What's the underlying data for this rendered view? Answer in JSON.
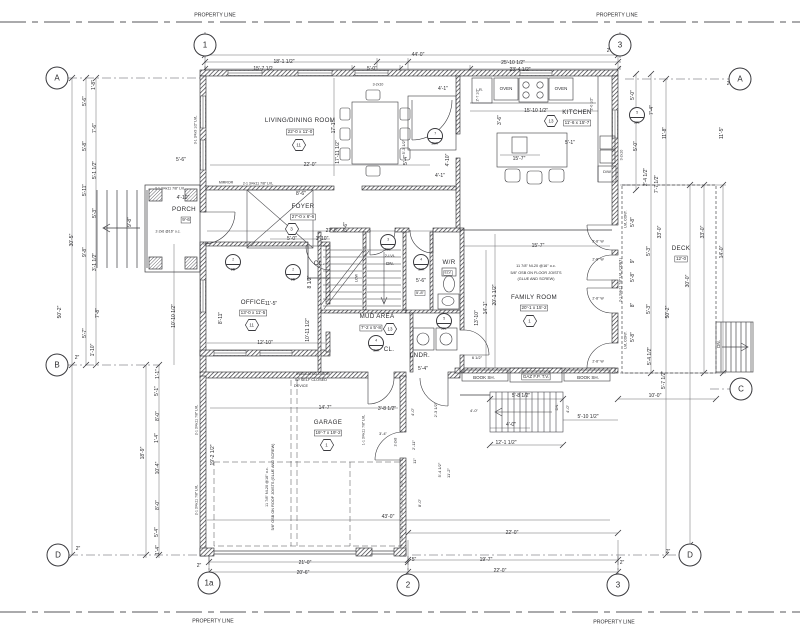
{
  "colors": {
    "background": "#ffffff",
    "line": "#5a5a5e",
    "wall": "#26262a",
    "text": "#2b2b2e"
  },
  "property_labels": [
    {
      "t": "PROPERTY LINE"
    },
    {
      "t": "PROPERTY LINE"
    },
    {
      "t": "PROPERTY LINE"
    },
    {
      "t": "PROPERTY LINE"
    }
  ],
  "grid_bubbles": [
    {
      "l": "1",
      "x": 205,
      "y": 45
    },
    {
      "l": "3",
      "x": 620,
      "y": 45
    },
    {
      "l": "A",
      "x": 57,
      "y": 78
    },
    {
      "l": "B",
      "x": 57,
      "y": 365
    },
    {
      "l": "D",
      "x": 58,
      "y": 555
    },
    {
      "l": "A",
      "x": 740,
      "y": 79
    },
    {
      "l": "C",
      "x": 741,
      "y": 389
    },
    {
      "l": "D",
      "x": 690,
      "y": 555
    },
    {
      "l": "1a",
      "x": 209,
      "y": 583
    },
    {
      "l": "2",
      "x": 408,
      "y": 585
    },
    {
      "l": "3",
      "x": 618,
      "y": 585
    }
  ],
  "rooms": [
    {
      "name": {
        "t": "LIVING/DINING ROOM",
        "x": 300,
        "y": 121
      },
      "size": {
        "t": "22'-0 x 11'-0",
        "x": 300,
        "y": 132
      },
      "tag": {
        "t": "11",
        "x": 299,
        "y": 145
      }
    },
    {
      "name": {
        "t": "KITCHEN",
        "x": 577,
        "y": 113
      },
      "size": {
        "t": "11'-6 x 15'-7",
        "x": 577,
        "y": 123
      },
      "tag": {
        "t": "13",
        "x": 551,
        "y": 121
      }
    },
    {
      "name": {
        "t": "FOYER",
        "x": 303,
        "y": 207
      },
      "size": {
        "t": "27'-0 x 6'-6",
        "x": 303,
        "y": 217
      },
      "tag": {
        "t": "3",
        "x": 292,
        "y": 229
      }
    },
    {
      "name": {
        "t": "PORCH",
        "x": 184,
        "y": 210
      },
      "size": {
        "t": "9'-6",
        "x": 186,
        "y": 220
      }
    },
    {
      "name": {
        "t": "OFFICE",
        "x": 253,
        "y": 303
      },
      "size": {
        "t": "13'-0 x 11'-5",
        "x": 253,
        "y": 313
      },
      "tag": {
        "t": "11",
        "x": 252,
        "y": 325
      }
    },
    {
      "name": {
        "t": "MUD AREA",
        "x": 377,
        "y": 317
      },
      "size": {
        "t": "7'-2 x 5'-8",
        "x": 371,
        "y": 328
      },
      "tag": {
        "t": "13",
        "x": 390,
        "y": 329
      }
    },
    {
      "name": {
        "t": "FAMILY ROOM",
        "x": 534,
        "y": 298
      },
      "size": {
        "t": "20'-1 x 15'-2",
        "x": 534,
        "y": 308
      },
      "tag": {
        "t": "1",
        "x": 530,
        "y": 321
      }
    },
    {
      "name": {
        "t": "GARAGE",
        "x": 328,
        "y": 423
      },
      "size": {
        "t": "19'-7 x 19'-2",
        "x": 328,
        "y": 433
      },
      "tag": {
        "t": "1",
        "x": 327,
        "y": 445
      }
    },
    {
      "name": {
        "t": "DECK",
        "x": 681,
        "y": 249
      },
      "size": {
        "t": "12'-0",
        "x": 681,
        "y": 259
      }
    },
    {
      "name": {
        "t": "W/R",
        "x": 449,
        "y": 263
      }
    },
    {
      "name": {
        "t": "LNDR.",
        "x": 420,
        "y": 356
      }
    },
    {
      "name": {
        "t": "CL.",
        "x": 319,
        "y": 264
      }
    },
    {
      "name": {
        "t": "CL.",
        "x": 389,
        "y": 350
      }
    }
  ],
  "door_tags": [
    {
      "top": "2",
      "bottom": "2B",
      "x": 233,
      "y": 262
    },
    {
      "top": "2",
      "bottom": "2B",
      "x": 293,
      "y": 272
    },
    {
      "top": "7",
      "bottom": "2BR",
      "x": 435,
      "y": 136
    },
    {
      "top": "3",
      "bottom": "30L",
      "x": 388,
      "y": 242
    },
    {
      "top": "4",
      "bottom": "30R",
      "x": 421,
      "y": 262
    },
    {
      "top": "4",
      "bottom": "30R",
      "x": 376,
      "y": 343
    },
    {
      "top": "5",
      "bottom": "30L",
      "x": 444,
      "y": 321
    },
    {
      "top": "5",
      "bottom": "30L",
      "x": 637,
      "y": 115
    }
  ],
  "labels": [
    {
      "t": "44'-0\"",
      "x": 418,
      "y": 55
    },
    {
      "t": "18'-1 1/2\"",
      "x": 284,
      "y": 62
    },
    {
      "t": "15'-7 1/2",
      "x": 263,
      "y": 69
    },
    {
      "t": "5'-0\"",
      "x": 372,
      "y": 69
    },
    {
      "t": "25'-10 1/2\"",
      "x": 513,
      "y": 63
    },
    {
      "t": "23'-4 1/2\"",
      "x": 520,
      "y": 70
    },
    {
      "t": "2\"",
      "x": 213,
      "y": 49
    },
    {
      "t": "2\"",
      "x": 609,
      "y": 51
    },
    {
      "t": "21'-0\"",
      "x": 305,
      "y": 563
    },
    {
      "t": "20'-6\"",
      "x": 303,
      "y": 573
    },
    {
      "t": "2\"",
      "x": 199,
      "y": 566
    },
    {
      "t": "5\"",
      "x": 414,
      "y": 560
    },
    {
      "t": "22'-0\"",
      "x": 512,
      "y": 533
    },
    {
      "t": "19'-7\"",
      "x": 486,
      "y": 560
    },
    {
      "t": "22'-0\"",
      "x": 500,
      "y": 571
    },
    {
      "t": "2\"",
      "x": 622,
      "y": 563
    },
    {
      "t": "2\"",
      "x": 668,
      "y": 552
    },
    {
      "t": "1'-8\"",
      "x": 94,
      "y": 85,
      "r": -90
    },
    {
      "t": "5'-6\"",
      "x": 85,
      "y": 101,
      "r": -90
    },
    {
      "t": "7'-6\"",
      "x": 95,
      "y": 128,
      "r": -90
    },
    {
      "t": "5'-8\"",
      "x": 85,
      "y": 146,
      "r": -90
    },
    {
      "t": "5'-1 1/2\"",
      "x": 95,
      "y": 170,
      "r": -90
    },
    {
      "t": "5'-11\"",
      "x": 85,
      "y": 190,
      "r": -90
    },
    {
      "t": "5'-3\"",
      "x": 95,
      "y": 213,
      "r": -90
    },
    {
      "t": "9'-8\"",
      "x": 85,
      "y": 252,
      "r": -90
    },
    {
      "t": "3'-1 1/2\"",
      "x": 95,
      "y": 262,
      "r": -90
    },
    {
      "t": "30'-5\"",
      "x": 72,
      "y": 240,
      "r": -90
    },
    {
      "t": "50'-2\"",
      "x": 60,
      "y": 312,
      "r": -90
    },
    {
      "t": "7'-8\"",
      "x": 98,
      "y": 313,
      "r": -90
    },
    {
      "t": "5'-7\"",
      "x": 85,
      "y": 333,
      "r": -90
    },
    {
      "t": "1'-10\"",
      "x": 93,
      "y": 350,
      "r": -90
    },
    {
      "t": "2\"",
      "x": 77,
      "y": 358
    },
    {
      "t": "2\"",
      "x": 78,
      "y": 549
    },
    {
      "t": "10'-10 1/2\"",
      "x": 174,
      "y": 316,
      "r": -90
    },
    {
      "t": "1'-1\"",
      "x": 158,
      "y": 374,
      "r": -90
    },
    {
      "t": "5'-1\"",
      "x": 157,
      "y": 391,
      "r": -90
    },
    {
      "t": "8'-0\"",
      "x": 158,
      "y": 416,
      "r": -90
    },
    {
      "t": "1'-4\"",
      "x": 157,
      "y": 438,
      "r": -90
    },
    {
      "t": "18'-9\"",
      "x": 143,
      "y": 453,
      "r": -90
    },
    {
      "t": "10'-4\"",
      "x": 158,
      "y": 468,
      "r": -90
    },
    {
      "t": "8'-0\"",
      "x": 158,
      "y": 505,
      "r": -90
    },
    {
      "t": "5'-4\"",
      "x": 157,
      "y": 532,
      "r": -90
    },
    {
      "t": "1'-4\"",
      "x": 158,
      "y": 550,
      "r": -90
    },
    {
      "t": "7'-4\"",
      "x": 652,
      "y": 110,
      "r": -90
    },
    {
      "t": "11'-8\"",
      "x": 665,
      "y": 133,
      "r": -90
    },
    {
      "t": "11'-5\"",
      "x": 722,
      "y": 133,
      "r": -90
    },
    {
      "t": "5'-0\"",
      "x": 636,
      "y": 146,
      "r": -90
    },
    {
      "t": "2'-4 1/2\"",
      "x": 646,
      "y": 177,
      "r": -90
    },
    {
      "t": "7'-7 1/2\"",
      "x": 657,
      "y": 184,
      "r": -90
    },
    {
      "t": "2\"",
      "x": 729,
      "y": 84
    },
    {
      "t": "33'-0\"",
      "x": 660,
      "y": 232,
      "r": -90
    },
    {
      "t": "33'-0\"",
      "x": 703,
      "y": 232,
      "r": -90
    },
    {
      "t": "30'-0\"",
      "x": 688,
      "y": 281,
      "r": -90
    },
    {
      "t": "14'-0\"",
      "x": 722,
      "y": 252,
      "r": -90
    },
    {
      "t": "50'-2\"",
      "x": 668,
      "y": 312,
      "r": -90
    },
    {
      "t": "5'-8\"",
      "x": 633,
      "y": 222,
      "r": -90
    },
    {
      "t": "9\"",
      "x": 633,
      "y": 261,
      "r": -90
    },
    {
      "t": "5'-3\"",
      "x": 649,
      "y": 251,
      "r": -90
    },
    {
      "t": "5'-8\"",
      "x": 633,
      "y": 277,
      "r": -90
    },
    {
      "t": "8\"",
      "x": 633,
      "y": 305,
      "r": -90
    },
    {
      "t": "5'-3\"",
      "x": 649,
      "y": 309,
      "r": -90
    },
    {
      "t": "5'-8\"",
      "x": 633,
      "y": 337,
      "r": -90
    },
    {
      "t": "5'-4 1/2\"",
      "x": 650,
      "y": 356,
      "r": -90
    },
    {
      "t": "LVL CONT.",
      "x": 626,
      "y": 219,
      "r": -90,
      "s": 3.5
    },
    {
      "t": "LVL CONT.",
      "x": 626,
      "y": 340,
      "r": -90,
      "s": 3.5
    },
    {
      "t": "2-1 3/4x11 7/8\" LVL (CONT.)",
      "x": 621,
      "y": 280,
      "r": -90,
      "s": 3.5
    },
    {
      "t": "5'-7 1/2\"",
      "x": 664,
      "y": 380,
      "r": -90
    },
    {
      "t": "10'-0\"",
      "x": 655,
      "y": 396
    },
    {
      "t": "2'-8\" W",
      "x": 598,
      "y": 242,
      "s": 3.5
    },
    {
      "t": "2'-8\" W",
      "x": 598,
      "y": 260,
      "s": 3.5
    },
    {
      "t": "2'-8\" W",
      "x": 598,
      "y": 299,
      "s": 3.5
    },
    {
      "t": "2'-8\" W",
      "x": 598,
      "y": 362,
      "s": 3.5
    },
    {
      "t": "OVEN",
      "x": 506,
      "y": 89,
      "s": 4.5
    },
    {
      "t": "OVEN",
      "x": 561,
      "y": 89,
      "s": 4.5
    },
    {
      "t": "R.",
      "x": 481,
      "y": 90,
      "s": 4
    },
    {
      "t": "15'-10 1/2\"",
      "x": 536,
      "y": 111
    },
    {
      "t": "3'-6\"",
      "x": 500,
      "y": 120,
      "r": -90
    },
    {
      "t": "5'-1\"",
      "x": 570,
      "y": 143
    },
    {
      "t": "15'-7\"",
      "x": 519,
      "y": 159
    },
    {
      "t": "D/W",
      "x": 607,
      "y": 172,
      "s": 4
    },
    {
      "t": "2'-0 1/2\"",
      "x": 592,
      "y": 104,
      "r": -90,
      "s": 3.5
    },
    {
      "t": "5'-0\"",
      "x": 633,
      "y": 95,
      "r": -90
    },
    {
      "t": "3-2x10",
      "x": 622,
      "y": 155,
      "r": -90,
      "s": 3.5
    },
    {
      "t": "4'-1\"",
      "x": 443,
      "y": 89
    },
    {
      "t": "2'-7 1/2\"",
      "x": 478,
      "y": 95,
      "r": -90,
      "s": 3.5
    },
    {
      "t": "4'-10\"",
      "x": 448,
      "y": 160,
      "r": -90
    },
    {
      "t": "4'-1\"",
      "x": 440,
      "y": 176
    },
    {
      "t": "5'-4\"",
      "x": 406,
      "y": 160,
      "r": -90
    },
    {
      "t": "5'-3 1/2\"",
      "x": 404,
      "y": 147,
      "r": -90,
      "s": 4
    },
    {
      "t": "22'-0\"",
      "x": 310,
      "y": 165
    },
    {
      "t": "17'-1\"",
      "x": 334,
      "y": 127,
      "r": -90
    },
    {
      "t": "17'-11 1/2\"",
      "x": 338,
      "y": 152,
      "r": -90
    },
    {
      "t": "3-2x10",
      "x": 378,
      "y": 85,
      "s": 3.5
    },
    {
      "t": "3-1 3/4x9 1/2\" LVL",
      "x": 196,
      "y": 130,
      "r": -90,
      "s": 3.5
    },
    {
      "t": "MIRROR",
      "x": 226,
      "y": 183,
      "s": 3.5
    },
    {
      "t": "2-1 3/4x11 7/8\" LVL",
      "x": 258,
      "y": 184,
      "s": 3.5
    },
    {
      "t": "8'-6\"",
      "x": 301,
      "y": 194
    },
    {
      "t": "27'-0\"",
      "x": 332,
      "y": 231
    },
    {
      "t": "5'-0\"",
      "x": 292,
      "y": 239
    },
    {
      "t": "1'-10\"",
      "x": 322,
      "y": 239
    },
    {
      "t": "6'-6\"",
      "x": 346,
      "y": 227,
      "r": -90
    },
    {
      "t": "8 1/2\"",
      "x": 310,
      "y": 282,
      "r": -90
    },
    {
      "t": "5'-6\"",
      "x": 181,
      "y": 160
    },
    {
      "t": "4'-10\"",
      "x": 183,
      "y": 198
    },
    {
      "t": "9'-8\"",
      "x": 130,
      "y": 222,
      "r": -90
    },
    {
      "t": "2-2x6 @16\" o.c.",
      "x": 168,
      "y": 232,
      "s": 3.5
    },
    {
      "t": "2-1 3/4x11 7/8\" LVL",
      "x": 170,
      "y": 189,
      "s": 3.5
    },
    {
      "t": "11'-5\"",
      "x": 271,
      "y": 304
    },
    {
      "t": "8'-11\"",
      "x": 221,
      "y": 318,
      "r": -90
    },
    {
      "t": "12'-10\"",
      "x": 265,
      "y": 343
    },
    {
      "t": "10'-11 1/2\"",
      "x": 308,
      "y": 330,
      "r": -90
    },
    {
      "t": "2-LVL",
      "x": 390,
      "y": 256,
      "s": 4
    },
    {
      "t": "DN.",
      "x": 390,
      "y": 264,
      "s": 4.5
    },
    {
      "t": "LOW",
      "x": 357,
      "y": 278,
      "r": -90,
      "s": 3.5
    },
    {
      "t": "5'-6\"",
      "x": 421,
      "y": 281
    },
    {
      "t": "5'-8\"",
      "x": 420,
      "y": 293,
      "b": 1,
      "s": 4
    },
    {
      "t": "ELV.",
      "x": 448,
      "y": 273,
      "b": 1,
      "s": 3.5
    },
    {
      "t": "5'-4\"",
      "x": 423,
      "y": 369
    },
    {
      "t": "6 1/2\"",
      "x": 477,
      "y": 358,
      "s": 4
    },
    {
      "t": "15'-7\"",
      "x": 538,
      "y": 246
    },
    {
      "t": "11 7/8\" NI-20 @16\" o.c.",
      "x": 536,
      "y": 266,
      "s": 3.8
    },
    {
      "t": "5/8\" OSB ON FLOOR JOISTS",
      "x": 536,
      "y": 273,
      "s": 3.8
    },
    {
      "t": "(GLUE AND SCREW)",
      "x": 536,
      "y": 279,
      "s": 3.8
    },
    {
      "t": "20'-1 1/2\"",
      "x": 495,
      "y": 295,
      "r": -90
    },
    {
      "t": "14'-1\"",
      "x": 486,
      "y": 308,
      "r": -90
    },
    {
      "t": "13'-10\"",
      "x": 477,
      "y": 318,
      "r": -90
    },
    {
      "t": "BOOK SH.",
      "x": 484,
      "y": 378,
      "s": 4.5
    },
    {
      "t": "GAZ F.P. T.V.",
      "x": 536,
      "y": 377,
      "s": 4.5,
      "b": 1
    },
    {
      "t": "BOOK SH.",
      "x": 588,
      "y": 378,
      "s": 4.5
    },
    {
      "t": "14'-7\"",
      "x": 325,
      "y": 408
    },
    {
      "t": "3'-8 1/2\"",
      "x": 387,
      "y": 409
    },
    {
      "t": "43'-0\"",
      "x": 388,
      "y": 517
    },
    {
      "t": "INSULATED DOOR",
      "x": 313,
      "y": 374,
      "s": 3.8
    },
    {
      "t": "W/ SELF CLOSED",
      "x": 311,
      "y": 380,
      "s": 3.8
    },
    {
      "t": "DEVICE",
      "x": 301,
      "y": 386,
      "s": 3.8
    },
    {
      "t": "11 7/8\" NI-20 @16\" o.c.",
      "x": 267,
      "y": 487,
      "r": -90,
      "s": 3.8
    },
    {
      "t": "5/8\" OSB ON ROOF JOISTS (GLUE AND SCREW)",
      "x": 273,
      "y": 487,
      "r": -90,
      "s": 3.8
    },
    {
      "t": "2-1 3/4x11 7/8\" LVL",
      "x": 197,
      "y": 420,
      "r": -90,
      "s": 3.5
    },
    {
      "t": "2-1 3/4x11 7/8\" LVL",
      "x": 197,
      "y": 500,
      "r": -90,
      "s": 3.5
    },
    {
      "t": "19'-2 1/2\"",
      "x": 213,
      "y": 455,
      "r": -90
    },
    {
      "t": "1-1 3/4x11 7/8\" LVL",
      "x": 364,
      "y": 430,
      "r": -90,
      "s": 3.5
    },
    {
      "t": "4'-0\"",
      "x": 413,
      "y": 412,
      "r": -90,
      "s": 4
    },
    {
      "t": "2'-3 1/2\"",
      "x": 436,
      "y": 410,
      "r": -90,
      "s": 4
    },
    {
      "t": "3'-4\"",
      "x": 383,
      "y": 434,
      "s": 4
    },
    {
      "t": "2-2x8",
      "x": 396,
      "y": 442,
      "r": -90,
      "s": 3.5
    },
    {
      "t": "2'-11\"",
      "x": 414,
      "y": 445,
      "r": -90,
      "s": 4
    },
    {
      "t": "11\"",
      "x": 415,
      "y": 461,
      "r": -90,
      "s": 4
    },
    {
      "t": "5'-4 1/2\"",
      "x": 440,
      "y": 470,
      "r": -90,
      "s": 4
    },
    {
      "t": "11'-2\"",
      "x": 449,
      "y": 473,
      "r": -90,
      "s": 4
    },
    {
      "t": "8'-0\"",
      "x": 420,
      "y": 503,
      "r": -90,
      "s": 4
    },
    {
      "t": "4'-0\"",
      "x": 474,
      "y": 411,
      "s": 4
    },
    {
      "t": "5'-8 1/2\"",
      "x": 521,
      "y": 396
    },
    {
      "t": "DN.",
      "x": 557,
      "y": 407,
      "r": -90,
      "s": 4
    },
    {
      "t": "4'-0\"",
      "x": 568,
      "y": 409,
      "r": -90,
      "s": 4
    },
    {
      "t": "5'-10 1/2\"",
      "x": 588,
      "y": 417
    },
    {
      "t": "4'-0\"",
      "x": 511,
      "y": 425
    },
    {
      "t": "12'-1 1/2\"",
      "x": 506,
      "y": 443
    },
    {
      "t": "DN.",
      "x": 719,
      "y": 344,
      "r": -90,
      "s": 4.5
    }
  ]
}
